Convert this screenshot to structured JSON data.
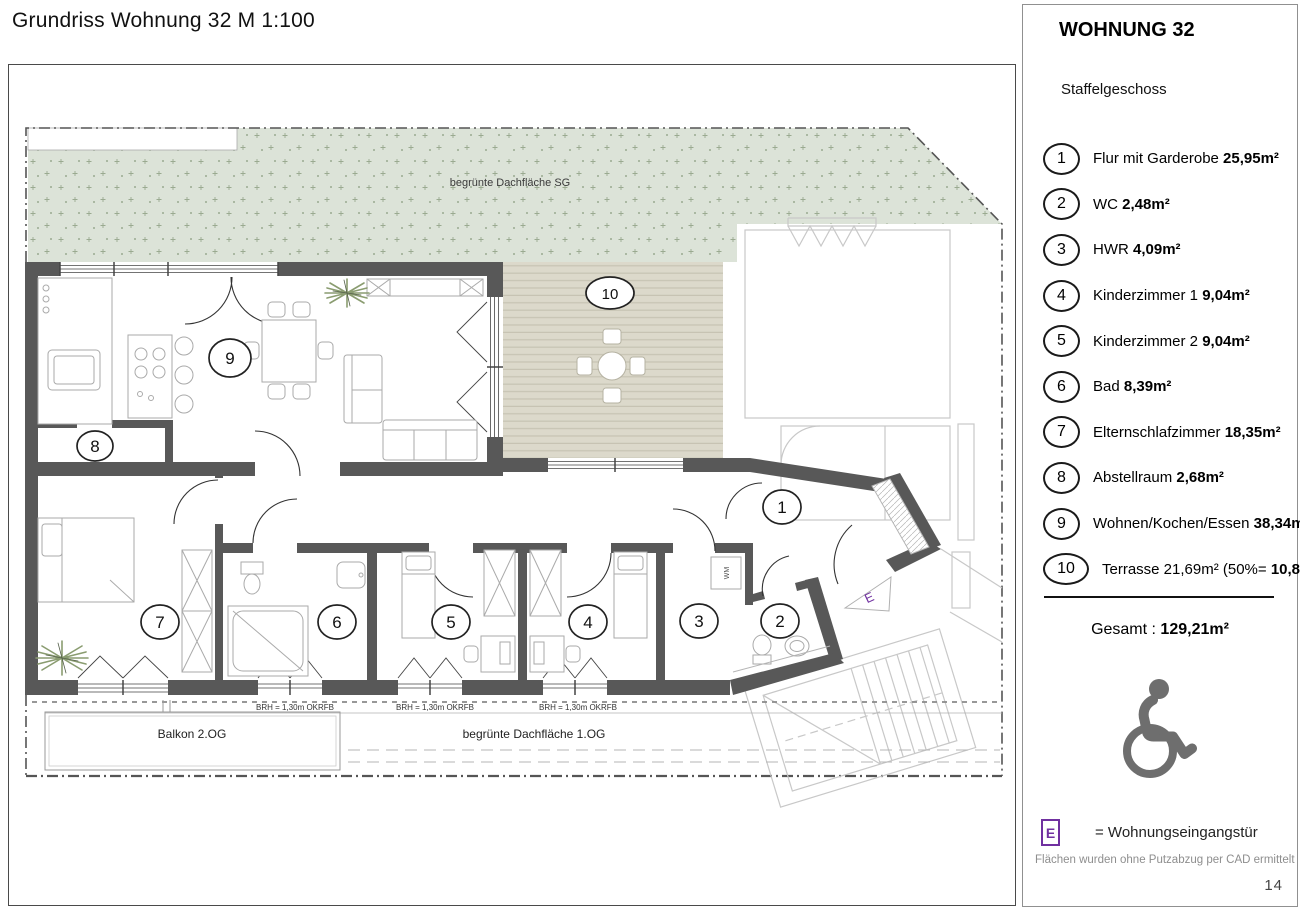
{
  "title": "Grundriss Wohnung 32 M 1:100",
  "page_number": "14",
  "sidebar": {
    "heading": "WOHNUNG 32",
    "subheading": "Staffelgeschoss",
    "rooms": [
      {
        "num": "1",
        "name": "Flur mit Garderobe",
        "area": "25,95m²"
      },
      {
        "num": "2",
        "name": "WC",
        "area": "2,48m²"
      },
      {
        "num": "3",
        "name": "HWR",
        "area": "4,09m²"
      },
      {
        "num": "4",
        "name": "Kinderzimmer 1",
        "area": "9,04m²"
      },
      {
        "num": "5",
        "name": "Kinderzimmer 2",
        "area": "9,04m²"
      },
      {
        "num": "6",
        "name": "Bad",
        "area": "8,39m²"
      },
      {
        "num": "7",
        "name": "Elternschlafzimmer",
        "area": "18,35m²"
      },
      {
        "num": "8",
        "name": "Abstellraum",
        "area": "2,68m²"
      },
      {
        "num": "9",
        "name": "Wohnen/Kochen/Essen",
        "area": "38,34m²"
      },
      {
        "num": "10",
        "name": "Terrasse 21,69m² (50%=",
        "area": "10,85m²)"
      }
    ],
    "total_label": "Gesamt :",
    "total_value": "129,21m²",
    "entrance_symbol": "E",
    "entrance_meaning": "= Wohnungseingangstür",
    "footnote": "Flächen wurden ohne Putzabzug per CAD ermittelt"
  },
  "plan": {
    "roof_sg_label": "begrünte Dachfläche SG",
    "balcony_label": "Balkon 2.OG",
    "roof_1og_label": "begrünte Dachfläche 1.OG",
    "brh_label": "BRH = 1,30m OKRFB",
    "washer_label": "WM",
    "entrance_symbol": "E",
    "markers": {
      "m1": "1",
      "m2": "2",
      "m3": "3",
      "m4": "4",
      "m5": "5",
      "m6": "6",
      "m7": "7",
      "m8": "8",
      "m9": "9",
      "m10": "10"
    }
  },
  "colors": {
    "wall": "#585858",
    "green_roof": "#dce3d8",
    "terrace": "#dcd9cb",
    "accent_purple": "#7030a0",
    "icon_gray": "#6e6e6e"
  }
}
